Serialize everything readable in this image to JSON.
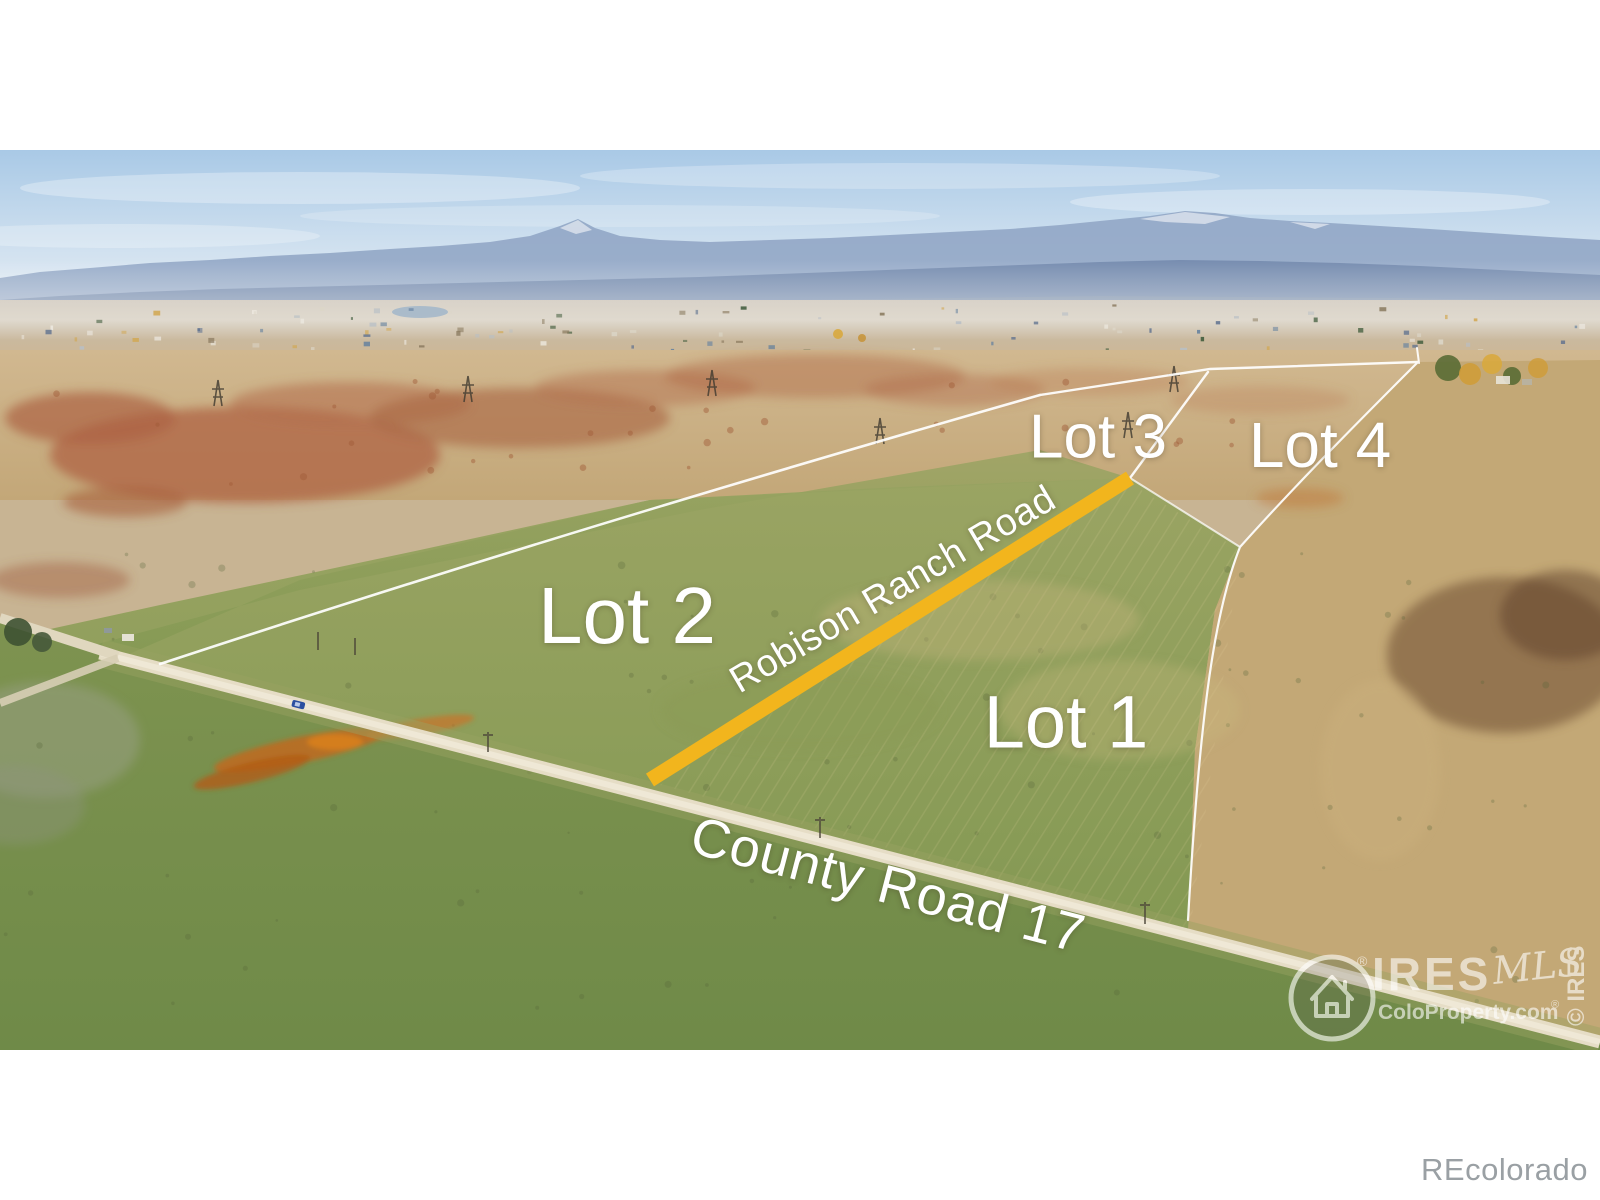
{
  "photo": {
    "lots": {
      "lot1": "Lot 1",
      "lot2": "Lot 2",
      "lot3": "Lot 3",
      "lot4": "Lot 4"
    },
    "roads": {
      "highlighted": "Robison Ranch Road",
      "county": "County Road 17"
    },
    "colors": {
      "highlight_road": "#f2b51d",
      "boundary": "#ffffff",
      "label_text": "#ffffff"
    },
    "watermark": {
      "brand": "IRES",
      "brand_script": "MLS",
      "registered": "®",
      "site": "ColoProperty.com",
      "site_registered": "®",
      "side_text": "© IRES"
    }
  },
  "footer": {
    "brand": "REcolorado"
  }
}
